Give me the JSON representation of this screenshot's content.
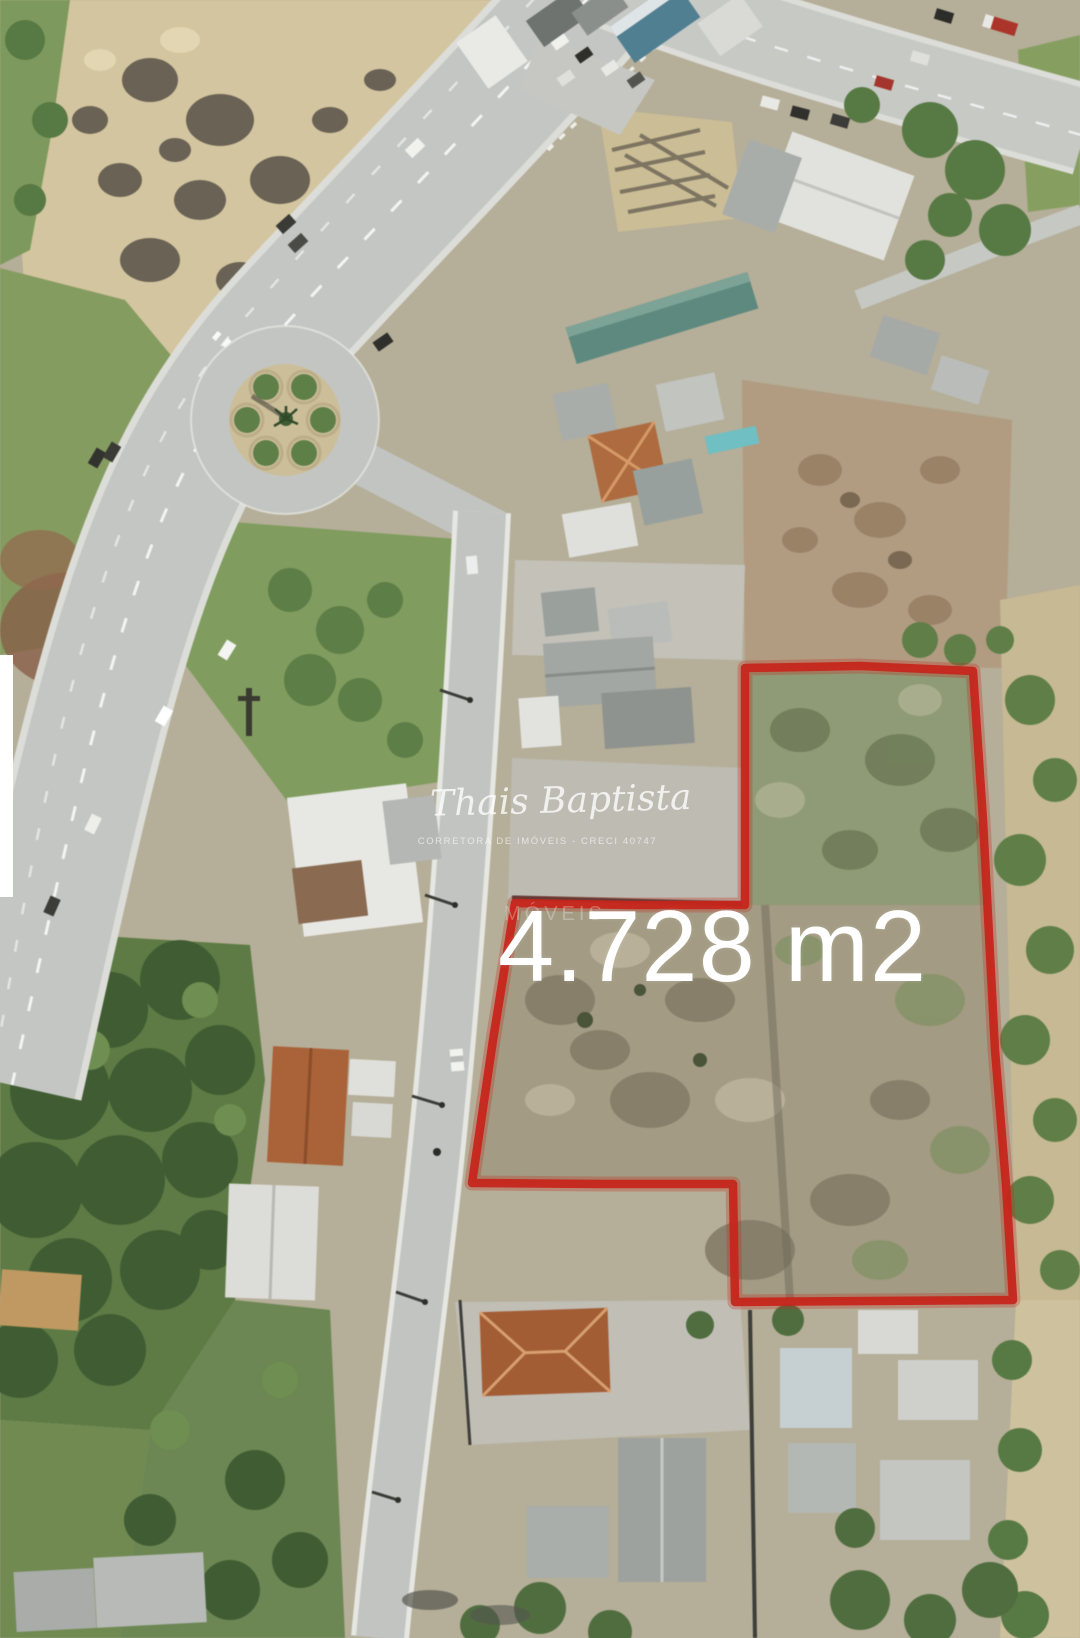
{
  "photo": {
    "area_label": "4.728 m2",
    "watermark": {
      "name": "Thais Baptista",
      "subtitle": "CORRETORA DE IMÓVEIS - CRECI 40747",
      "fragment": "MÓVEIS"
    },
    "plot": {
      "outline_points": "745,668 860,666 973,671 983,820 995,1050 1006,1185 1013,1300 870,1301 735,1302 733,1184 600,1184 472,1183 493,1040 515,903 630,905 745,905",
      "outline_color": "#c5261b"
    },
    "colors": {
      "boundary_red": "#c5261b",
      "label_white": "#ffffff",
      "road_gray": "#c4c6c3",
      "grass_green": "#7d9a5a",
      "sand_tan": "#d4c59d"
    }
  }
}
